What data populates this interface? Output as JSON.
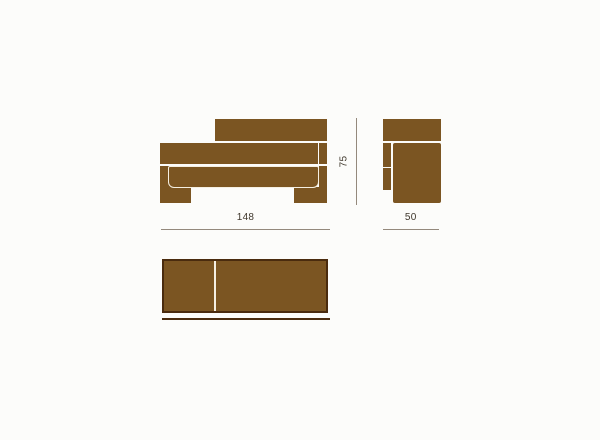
{
  "dimensions": {
    "width": "148",
    "depth": "50",
    "height": "75"
  },
  "colors": {
    "bg": "#fcfcfa",
    "fill": "#7b5522",
    "dark": "#4a2b0e",
    "gap": "#f5efe2",
    "dim_line": "#94897c",
    "dim_text": "#3f372c"
  }
}
